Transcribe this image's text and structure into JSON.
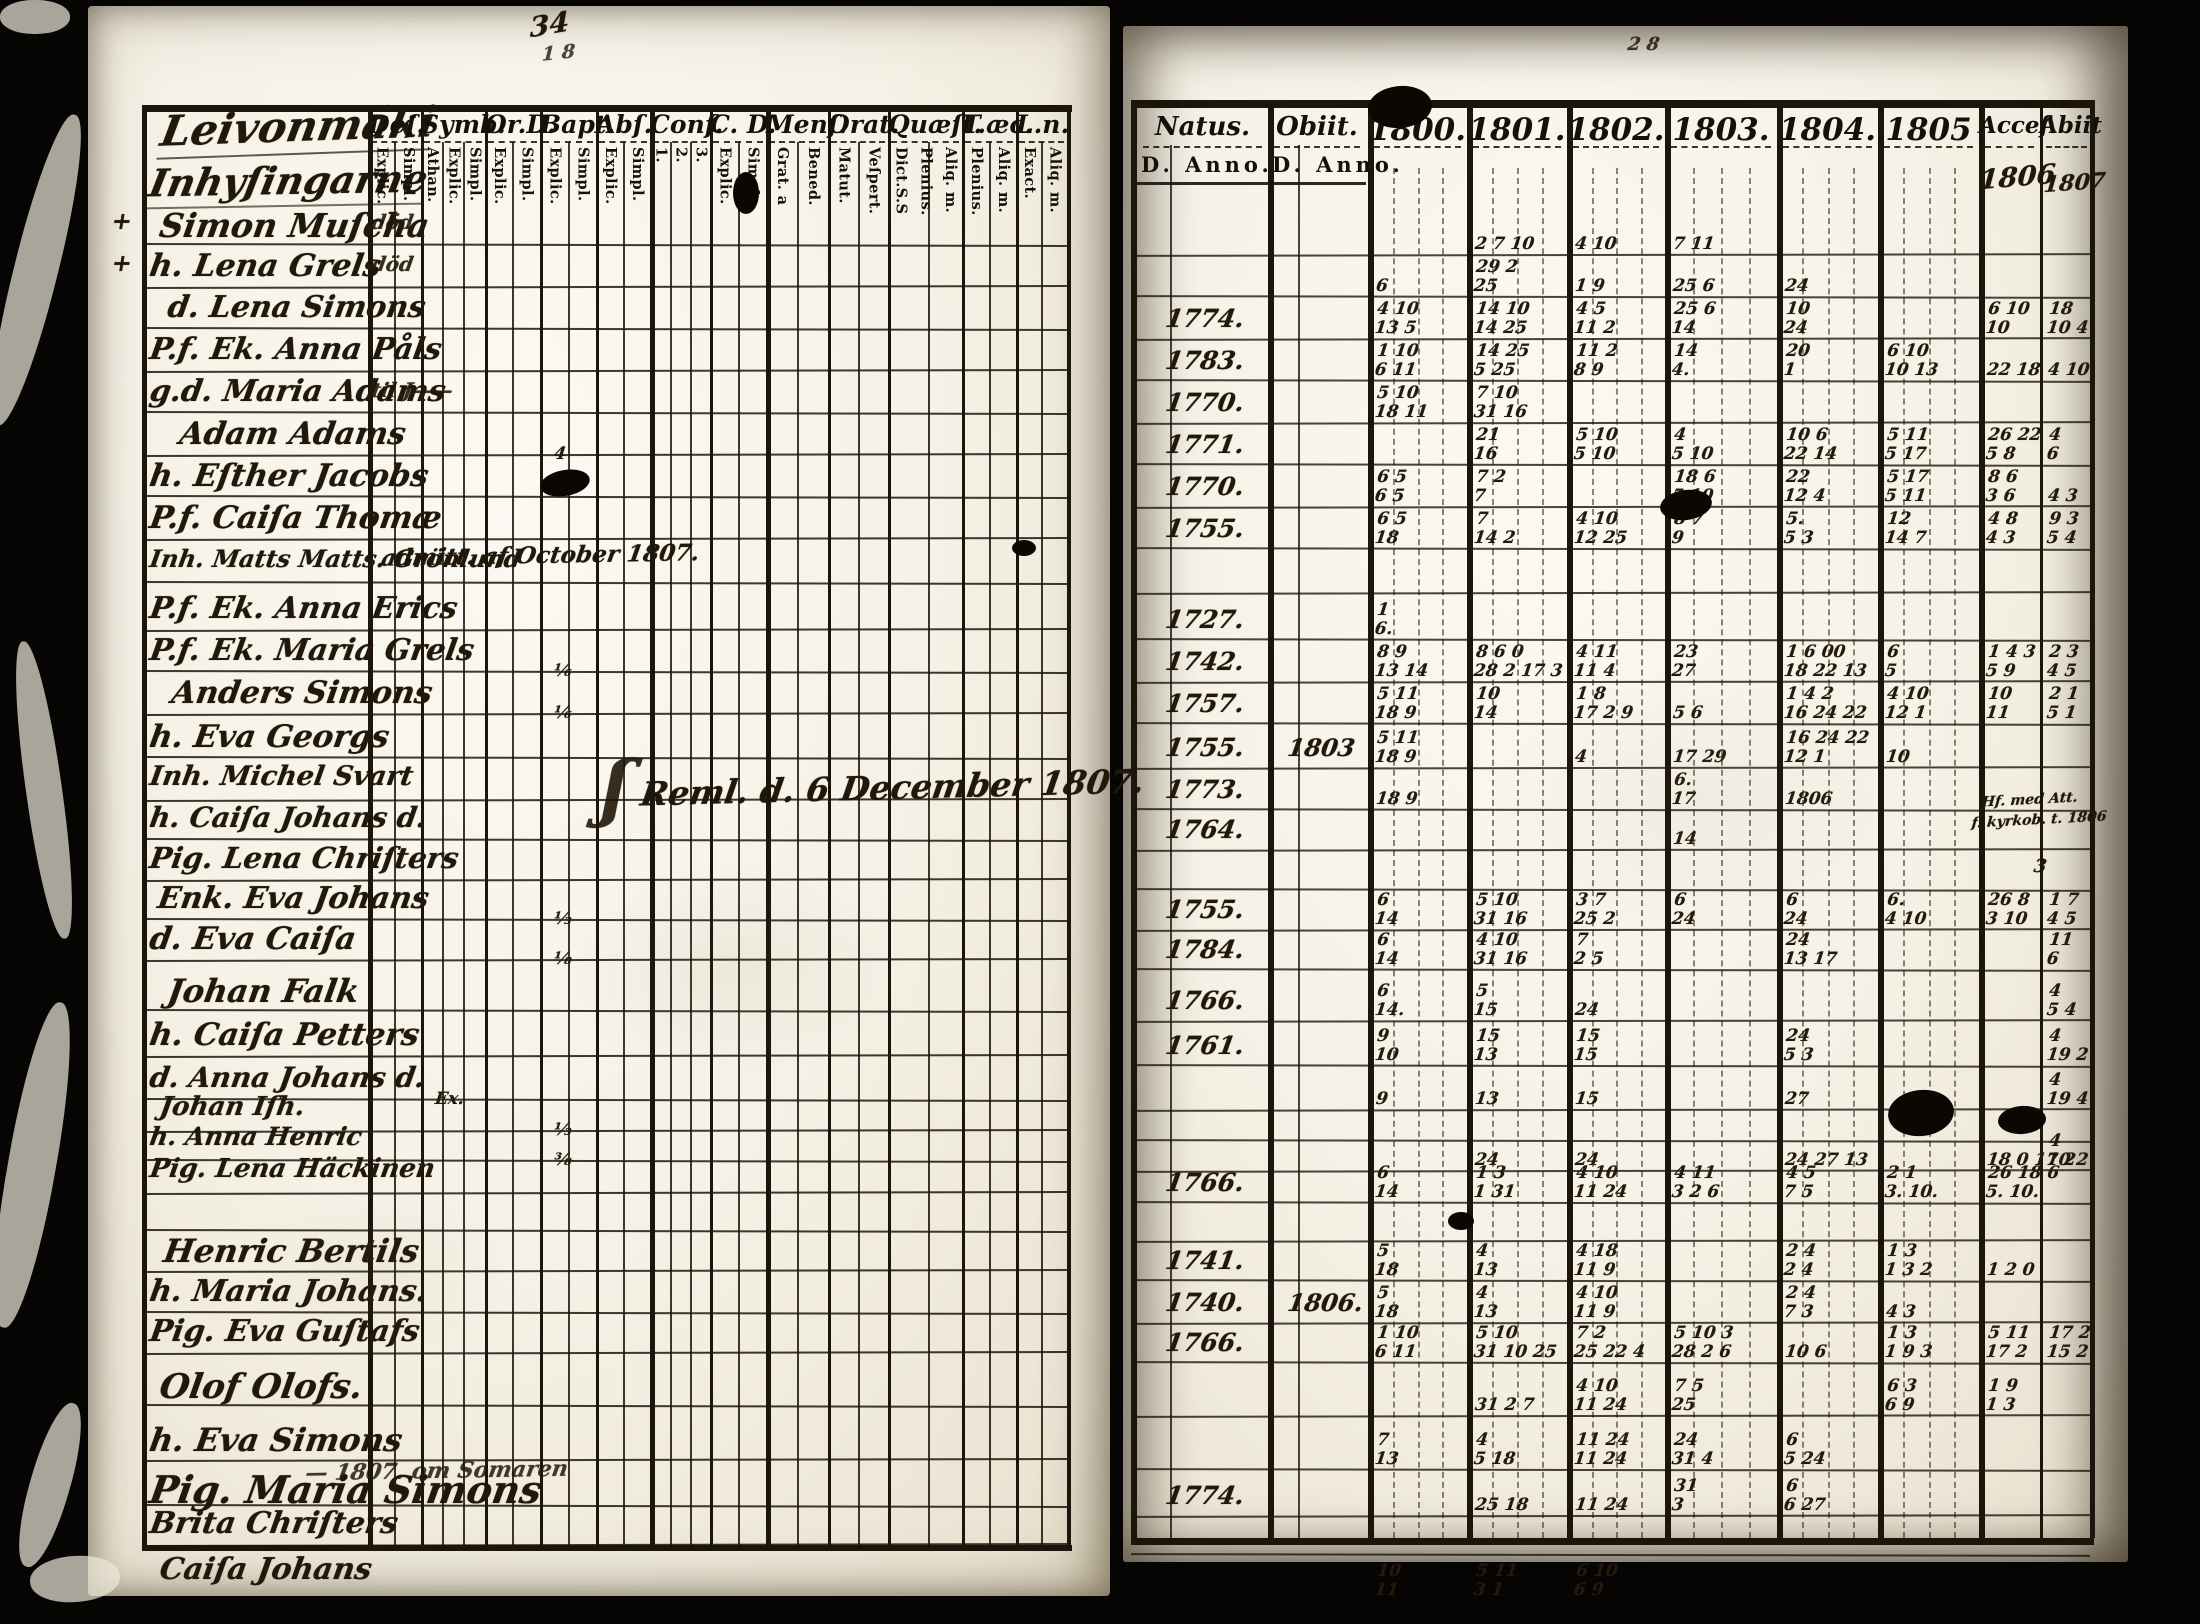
{
  "left_page": {
    "title_line1": "Leivonmäki",
    "title_line2": "Inhyſingarne",
    "page_number": "34",
    "page_number2": "1 8",
    "columns": [
      {
        "key": "des",
        "label": "Deſ.",
        "subs": [
          "Explic.",
          "Simpl."
        ]
      },
      {
        "key": "symb",
        "label": "Symb:",
        "subs": [
          "Athan.",
          "Explic.",
          "Simpl."
        ]
      },
      {
        "key": "ord",
        "label": "Or.D.",
        "subs": [
          "Explic.",
          "Simpl."
        ]
      },
      {
        "key": "bapt",
        "label": "Bapt.",
        "subs": [
          "Explic.",
          "Simpl."
        ]
      },
      {
        "key": "abs",
        "label": "Abſ.",
        "subs": [
          "Explic.",
          "Simpl."
        ]
      },
      {
        "key": "conf",
        "label": "Conf.",
        "subs": [
          "1.",
          "2.",
          "3."
        ]
      },
      {
        "key": "cd",
        "label": "C. D.",
        "subs": [
          "Explic.",
          "Simpl."
        ]
      },
      {
        "key": "mens",
        "label": "Menſ.",
        "subs": [
          "Grat. a",
          "Bened."
        ]
      },
      {
        "key": "orat",
        "label": "Orat.",
        "subs": [
          "Matut.",
          "Veſpert."
        ]
      },
      {
        "key": "quaest",
        "label": "Quæſt.",
        "subs": [
          "Dict.S.S",
          "Plenius.",
          "Aliq. m."
        ]
      },
      {
        "key": "taec",
        "label": "T.æc.",
        "subs": [
          "Plenius.",
          "Aliq. m."
        ]
      },
      {
        "key": "ln",
        "label": "L.n.",
        "subs": [
          "Exact.",
          "Aliq. m."
        ]
      }
    ],
    "rows": [
      {
        "name": "Simon Muſcha",
        "des": "död",
        "natus": "",
        "obiit": ""
      },
      {
        "name": "h. Lena Grels",
        "des": "död",
        "natus": "",
        "obiit": ""
      },
      {
        "name": "d. Lena Simons",
        "des": "",
        "natus": "1774.",
        "obiit": ""
      },
      {
        "name": "P.f. Ek. Anna Påls",
        "des": "",
        "natus": "1783.",
        "obiit": ""
      },
      {
        "name": "g.d. Maria Adams",
        "des": "til J——",
        "natus": "1770.",
        "obiit": ""
      },
      {
        "name": "Adam Adams",
        "des": "",
        "natus": "1771.",
        "obiit": ""
      },
      {
        "name": "h. Eſther Jacobs",
        "des": "",
        "natus": "1770.",
        "obiit": ""
      },
      {
        "name": "P.f. Caiſa Thomæ",
        "des": "",
        "natus": "1755.",
        "obiit": ""
      },
      {
        "name": "Inh. Matts Matts. Grönlund",
        "des": "",
        "natus": "",
        "obiit": ""
      },
      {
        "name": "P.f. Ek. Anna Erics",
        "des": "",
        "natus": "1727.",
        "obiit": ""
      },
      {
        "name": "P.f. Ek. Maria Grels",
        "des": "",
        "natus": "1742.",
        "obiit": ""
      },
      {
        "name": "Anders Simons",
        "des": "",
        "natus": "1757.",
        "obiit": ""
      },
      {
        "name": "h. Eva Georgs",
        "des": "",
        "natus": "1755.",
        "obiit": "1803"
      },
      {
        "name": "Inh. Michel Svart",
        "des": "",
        "natus": "1773.",
        "obiit": ""
      },
      {
        "name": "h. Caiſa Johans d.",
        "des": "",
        "natus": "1764.",
        "obiit": ""
      },
      {
        "name": "Pig. Lena Chriſters",
        "des": "",
        "natus": "",
        "obiit": ""
      },
      {
        "name": "Enk. Eva Johans",
        "des": "",
        "natus": "1755.",
        "obiit": ""
      },
      {
        "name": "d. Eva Caiſa",
        "des": "",
        "natus": "1784.",
        "obiit": ""
      },
      {
        "name": "Johan Falk",
        "des": "",
        "natus": "1766.",
        "obiit": ""
      },
      {
        "name": "h. Caiſa Petters",
        "des": "",
        "natus": "1761.",
        "obiit": ""
      },
      {
        "name": "d. Anna Johans d.",
        "des": "",
        "natus": "",
        "obiit": ""
      },
      {
        "name": "Johan Iſh.",
        "des": "",
        "natus": "",
        "obiit": ""
      },
      {
        "name": "h. Anna Henric",
        "des": "",
        "natus": "",
        "obiit": ""
      },
      {
        "name": "Pig. Lena Häckinen",
        "des": "",
        "natus": "1766.",
        "obiit": ""
      },
      {
        "name": "",
        "des": "",
        "natus": "",
        "obiit": ""
      },
      {
        "name": "Henric Bertils",
        "des": "",
        "natus": "1741.",
        "obiit": ""
      },
      {
        "name": "h. Maria Johans.",
        "des": "",
        "natus": "1740.",
        "obiit": "1806."
      },
      {
        "name": "Pig. Eva Guſtafs",
        "des": "",
        "natus": "1766.",
        "obiit": ""
      },
      {
        "name": "Olof Olofs.",
        "des": "",
        "natus": "",
        "obiit": ""
      },
      {
        "name": "h. Eva Simons",
        "des": "",
        "natus": "",
        "obiit": ""
      },
      {
        "name": "Pig. Maria Simons",
        "des": "",
        "natus": "1774.",
        "obiit": ""
      },
      {
        "name": "Brita Chriſters",
        "des": "",
        "natus": "",
        "obiit": ""
      },
      {
        "name": "Caiſa Johans",
        "des": "",
        "natus": "",
        "obiit": ""
      }
    ],
    "notes": {
      "row9": "admitt. af October 1807.",
      "center_flourish": "ʃ",
      "center": "Reml. d. 6 December 1807.",
      "row31_above": "— 1807. om Somaren",
      "margin_cross_1": "+",
      "margin_cross_2": "+"
    },
    "cell_marks": [
      {
        "r": 6,
        "c": "bapt",
        "t": "4"
      },
      {
        "r": 11,
        "c": "bapt",
        "t": "⅙"
      },
      {
        "r": 12,
        "c": "bapt",
        "t": "⅙"
      },
      {
        "r": 17,
        "c": "bapt",
        "t": "⅓"
      },
      {
        "r": 18,
        "c": "bapt",
        "t": "⅛"
      },
      {
        "r": 22,
        "c": "bapt",
        "t": "⅓"
      },
      {
        "r": 23,
        "c": "bapt",
        "t": "⅜"
      },
      {
        "r": 21,
        "c": "symb",
        "t": "Ex."
      }
    ]
  },
  "right_page": {
    "columns": [
      {
        "key": "natus",
        "label": "Natus.",
        "subs": [
          "D.",
          "Anno."
        ]
      },
      {
        "key": "obiit",
        "label": "Obiit.",
        "subs": [
          "D.",
          "Anno."
        ]
      },
      {
        "key": "y1800",
        "label": "1800."
      },
      {
        "key": "y1801",
        "label": "1801."
      },
      {
        "key": "y1802",
        "label": "1802."
      },
      {
        "key": "y1803",
        "label": "1803."
      },
      {
        "key": "y1804",
        "label": "1804."
      },
      {
        "key": "y1805",
        "label": "1805"
      },
      {
        "key": "acc",
        "label": "Acceſ."
      },
      {
        "key": "abi",
        "label": "Abiit"
      }
    ],
    "notes": {
      "acces_year": "1806",
      "abiit_year": "1807",
      "row14_note_1": "Hf. med Att.",
      "row14_note_2": "f. kyrkob. t. 1806",
      "row15_note": "3",
      "top_mark": "2 8"
    },
    "cell_marks": [
      {
        "r": 1,
        "c": "y1801",
        "t": "2 7 10"
      },
      {
        "r": 1,
        "c": "y1802",
        "t": "4 10"
      },
      {
        "r": 1,
        "c": "y1803",
        "t": "7 11"
      },
      {
        "r": 2,
        "c": "y1800",
        "t": "6"
      },
      {
        "r": 2,
        "c": "y1801",
        "t": "29 2|25"
      },
      {
        "r": 2,
        "c": "y1802",
        "t": "1 9"
      },
      {
        "r": 2,
        "c": "y1803",
        "t": "25 6"
      },
      {
        "r": 2,
        "c": "y1804",
        "t": "24"
      },
      {
        "r": 3,
        "c": "y1800",
        "t": "4 10|13 5"
      },
      {
        "r": 3,
        "c": "y1801",
        "t": "14 10|14 25"
      },
      {
        "r": 3,
        "c": "y1802",
        "t": "4 5|11 2"
      },
      {
        "r": 3,
        "c": "y1803",
        "t": "25 6|14"
      },
      {
        "r": 3,
        "c": "y1804",
        "t": "10|24"
      },
      {
        "r": 3,
        "c": "acc",
        "t": "6 10|10"
      },
      {
        "r": 3,
        "c": "abi",
        "t": "18|10 4"
      },
      {
        "r": 4,
        "c": "y1800",
        "t": "1 10|6 11"
      },
      {
        "r": 4,
        "c": "y1801",
        "t": "14 25|5 25"
      },
      {
        "r": 4,
        "c": "y1802",
        "t": "11 2|8 9"
      },
      {
        "r": 4,
        "c": "y1803",
        "t": "14|4."
      },
      {
        "r": 4,
        "c": "y1804",
        "t": "20|1"
      },
      {
        "r": 4,
        "c": "y1805",
        "t": "6 10|10 13"
      },
      {
        "r": 4,
        "c": "acc",
        "t": "22 18"
      },
      {
        "r": 4,
        "c": "abi",
        "t": "4 10"
      },
      {
        "r": 5,
        "c": "y1800",
        "t": "5 10|18 11"
      },
      {
        "r": 5,
        "c": "y1801",
        "t": "7 10|31 16"
      },
      {
        "r": 6,
        "c": "y1801",
        "t": "21|16"
      },
      {
        "r": 6,
        "c": "y1802",
        "t": "5 10|5 10"
      },
      {
        "r": 6,
        "c": "y1803",
        "t": "4|5 10"
      },
      {
        "r": 6,
        "c": "y1804",
        "t": "10 6|22 14"
      },
      {
        "r": 6,
        "c": "y1805",
        "t": "5 11|5 17"
      },
      {
        "r": 6,
        "c": "acc",
        "t": "26 22|5 8"
      },
      {
        "r": 6,
        "c": "abi",
        "t": "4|6"
      },
      {
        "r": 7,
        "c": "y1800",
        "t": "6 5|6 5"
      },
      {
        "r": 7,
        "c": "y1801",
        "t": "7 2|7"
      },
      {
        "r": 7,
        "c": "y1803",
        "t": "18 6|5 10"
      },
      {
        "r": 7,
        "c": "y1804",
        "t": "22|12 4"
      },
      {
        "r": 7,
        "c": "y1805",
        "t": "5 17|5 11"
      },
      {
        "r": 7,
        "c": "acc",
        "t": "8 6|3 6"
      },
      {
        "r": 7,
        "c": "abi",
        "t": "4 3"
      },
      {
        "r": 8,
        "c": "y1800",
        "t": "6 5|18"
      },
      {
        "r": 8,
        "c": "y1801",
        "t": "7|14 2"
      },
      {
        "r": 8,
        "c": "y1802",
        "t": "4 10|12 25"
      },
      {
        "r": 8,
        "c": "y1803",
        "t": "8 7|9"
      },
      {
        "r": 8,
        "c": "y1804",
        "t": "5.|5 3"
      },
      {
        "r": 8,
        "c": "y1805",
        "t": "12|14 7"
      },
      {
        "r": 8,
        "c": "acc",
        "t": "4 8|4 3"
      },
      {
        "r": 8,
        "c": "abi",
        "t": "9 3|5 4"
      },
      {
        "r": 10,
        "c": "y1800",
        "t": "1|6."
      },
      {
        "r": 11,
        "c": "y1800",
        "t": "8 9|13 14"
      },
      {
        "r": 11,
        "c": "y1801",
        "t": "8 6 0|28 2 17 3"
      },
      {
        "r": 11,
        "c": "y1802",
        "t": "4 11|11 4"
      },
      {
        "r": 11,
        "c": "y1803",
        "t": "23|27"
      },
      {
        "r": 11,
        "c": "y1804",
        "t": "1 6 00|18 22 13"
      },
      {
        "r": 11,
        "c": "y1805",
        "t": "6|5"
      },
      {
        "r": 11,
        "c": "acc",
        "t": "1 4 3|5 9"
      },
      {
        "r": 11,
        "c": "abi",
        "t": "2 3|4 5"
      },
      {
        "r": 12,
        "c": "y1800",
        "t": "5 11|18 9"
      },
      {
        "r": 12,
        "c": "y1801",
        "t": "10|14"
      },
      {
        "r": 12,
        "c": "y1802",
        "t": "1 8|17 2 9"
      },
      {
        "r": 12,
        "c": "y1803",
        "t": "5 6"
      },
      {
        "r": 12,
        "c": "y1804",
        "t": "1 4 2|16 24 22"
      },
      {
        "r": 12,
        "c": "y1805",
        "t": "4 10|12 1"
      },
      {
        "r": 12,
        "c": "acc",
        "t": "10|11"
      },
      {
        "r": 12,
        "c": "abi",
        "t": "2 1|5 1"
      },
      {
        "r": 13,
        "c": "y1800",
        "t": "5 11|18 9"
      },
      {
        "r": 13,
        "c": "y1802",
        "t": "4"
      },
      {
        "r": 13,
        "c": "y1803",
        "t": "17 29"
      },
      {
        "r": 13,
        "c": "y1804",
        "t": "16 24 22|12 1"
      },
      {
        "r": 13,
        "c": "y1805",
        "t": "10"
      },
      {
        "r": 14,
        "c": "y1800",
        "t": "18 9"
      },
      {
        "r": 14,
        "c": "y1803",
        "t": "6.|17"
      },
      {
        "r": 14,
        "c": "y1804",
        "t": "1806"
      },
      {
        "r": 15,
        "c": "y1803",
        "t": "14"
      },
      {
        "r": 17,
        "c": "y1800",
        "t": "6|14"
      },
      {
        "r": 17,
        "c": "y1801",
        "t": "5 10|31 16"
      },
      {
        "r": 17,
        "c": "y1802",
        "t": "3 7|25 2"
      },
      {
        "r": 17,
        "c": "y1803",
        "t": "6|24"
      },
      {
        "r": 17,
        "c": "y1804",
        "t": "6|24"
      },
      {
        "r": 17,
        "c": "y1805",
        "t": "6.|4 10"
      },
      {
        "r": 17,
        "c": "acc",
        "t": "26 8|3 10"
      },
      {
        "r": 17,
        "c": "abi",
        "t": "1 7|4 5"
      },
      {
        "r": 18,
        "c": "y1800",
        "t": "6|14"
      },
      {
        "r": 18,
        "c": "y1801",
        "t": "4 10|31 16"
      },
      {
        "r": 18,
        "c": "y1802",
        "t": "7|2 5"
      },
      {
        "r": 18,
        "c": "y1804",
        "t": "24|13 17"
      },
      {
        "r": 18,
        "c": "abi",
        "t": "11|6"
      },
      {
        "r": 19,
        "c": "y1800",
        "t": "6|14."
      },
      {
        "r": 19,
        "c": "y1801",
        "t": "5|15"
      },
      {
        "r": 19,
        "c": "y1802",
        "t": "24"
      },
      {
        "r": 19,
        "c": "abi",
        "t": "4|5 4"
      },
      {
        "r": 20,
        "c": "y1800",
        "t": "9|10"
      },
      {
        "r": 20,
        "c": "y1801",
        "t": "15|13"
      },
      {
        "r": 20,
        "c": "y1802",
        "t": "15|15"
      },
      {
        "r": 20,
        "c": "y1804",
        "t": "24|5 3"
      },
      {
        "r": 20,
        "c": "abi",
        "t": "4|19 2"
      },
      {
        "r": 21,
        "c": "y1800",
        "t": "9"
      },
      {
        "r": 21,
        "c": "y1801",
        "t": "13"
      },
      {
        "r": 21,
        "c": "y1802",
        "t": "15"
      },
      {
        "r": 21,
        "c": "y1804",
        "t": "27"
      },
      {
        "r": 21,
        "c": "abi",
        "t": "4|19 4"
      },
      {
        "r": 23,
        "c": "y1801",
        "t": "24"
      },
      {
        "r": 23,
        "c": "y1802",
        "t": "24"
      },
      {
        "r": 23,
        "c": "y1804",
        "t": "24 27 13"
      },
      {
        "r": 23,
        "c": "acc",
        "t": "18 0 17 2"
      },
      {
        "r": 23,
        "c": "abi",
        "t": "4|10 2"
      },
      {
        "r": 24,
        "c": "y1800",
        "t": "6|14"
      },
      {
        "r": 24,
        "c": "y1801",
        "t": "1 3|1 31"
      },
      {
        "r": 24,
        "c": "y1802",
        "t": "4 10|11 24"
      },
      {
        "r": 24,
        "c": "y1803",
        "t": "4 11|3 2 6"
      },
      {
        "r": 24,
        "c": "y1804",
        "t": "4 5|7 5"
      },
      {
        "r": 24,
        "c": "y1805",
        "t": "2 1|3. 10."
      },
      {
        "r": 24,
        "c": "acc",
        "t": "26 18 6|5. 10."
      },
      {
        "r": 26,
        "c": "y1800",
        "t": "5|18"
      },
      {
        "r": 26,
        "c": "y1801",
        "t": "4|13"
      },
      {
        "r": 26,
        "c": "y1802",
        "t": "4 18|11 9"
      },
      {
        "r": 26,
        "c": "y1804",
        "t": "2 4|2 4"
      },
      {
        "r": 26,
        "c": "y1805",
        "t": "1 3|1 3 2"
      },
      {
        "r": 26,
        "c": "acc",
        "t": "1 2 0"
      },
      {
        "r": 27,
        "c": "y1800",
        "t": "5|18"
      },
      {
        "r": 27,
        "c": "y1801",
        "t": "4|13"
      },
      {
        "r": 27,
        "c": "y1802",
        "t": "4 10|11 9"
      },
      {
        "r": 27,
        "c": "y1804",
        "t": "2 4|7 3"
      },
      {
        "r": 27,
        "c": "y1805",
        "t": "4 3"
      },
      {
        "r": 28,
        "c": "y1800",
        "t": "1 10|6 11"
      },
      {
        "r": 28,
        "c": "y1801",
        "t": "5 10|31 10 25"
      },
      {
        "r": 28,
        "c": "y1802",
        "t": "7 2|25 22 4"
      },
      {
        "r": 28,
        "c": "y1803",
        "t": "5 10 3|28 2 6"
      },
      {
        "r": 28,
        "c": "y1804",
        "t": "10 6"
      },
      {
        "r": 28,
        "c": "y1805",
        "t": "1 3|1 9 3"
      },
      {
        "r": 28,
        "c": "acc",
        "t": "5 11|17 2"
      },
      {
        "r": 28,
        "c": "abi",
        "t": "17 2|15 2"
      },
      {
        "r": 29,
        "c": "y1801",
        "t": "31 2 7"
      },
      {
        "r": 29,
        "c": "y1802",
        "t": "4 10|11 24"
      },
      {
        "r": 29,
        "c": "y1803",
        "t": "7 5|25"
      },
      {
        "r": 29,
        "c": "y1805",
        "t": "6 3|6 9"
      },
      {
        "r": 29,
        "c": "acc",
        "t": "1 9|1 3"
      },
      {
        "r": 30,
        "c": "y1800",
        "t": "7|13"
      },
      {
        "r": 30,
        "c": "y1801",
        "t": "4|5 18"
      },
      {
        "r": 30,
        "c": "y1802",
        "t": "11 24|11 24"
      },
      {
        "r": 30,
        "c": "y1803",
        "t": "24|31 4"
      },
      {
        "r": 30,
        "c": "y1804",
        "t": "6|5 24"
      },
      {
        "r": 31,
        "c": "y1801",
        "t": "25 18"
      },
      {
        "r": 31,
        "c": "y1802",
        "t": "11 24"
      },
      {
        "r": 31,
        "c": "y1803",
        "t": "31|3"
      },
      {
        "r": 31,
        "c": "y1804",
        "t": "6|6 27"
      },
      {
        "r": 33,
        "c": "y1800",
        "t": "10|11"
      },
      {
        "r": 33,
        "c": "y1801",
        "t": "5 11|3 1"
      },
      {
        "r": 33,
        "c": "y1802",
        "t": "6 10|6 9"
      }
    ]
  }
}
